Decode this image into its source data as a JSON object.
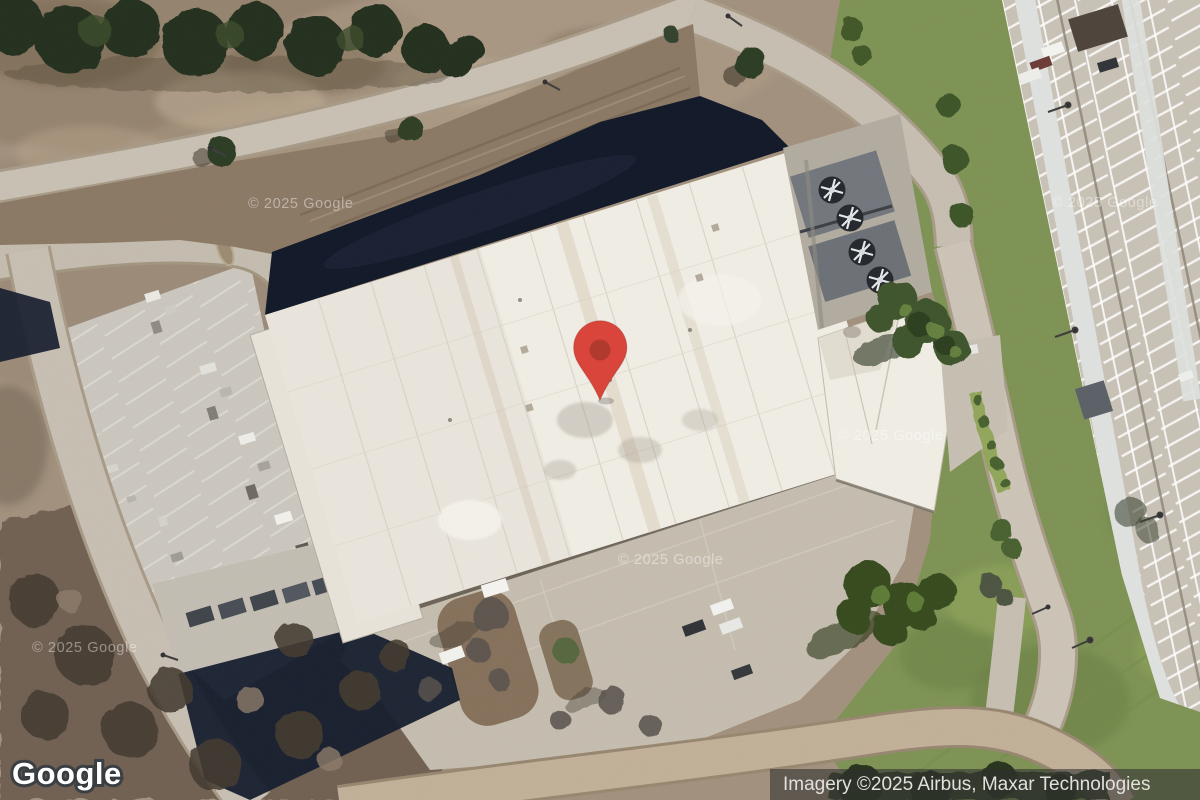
{
  "map_overlay": {
    "logo_text": "Google",
    "attribution_text": "Imagery ©2025 Airbus, Maxar Technologies",
    "imagery_watermark": "© 2025 Google"
  },
  "marker": {
    "fill": "#d9453a",
    "inner": "#b13a2f"
  }
}
